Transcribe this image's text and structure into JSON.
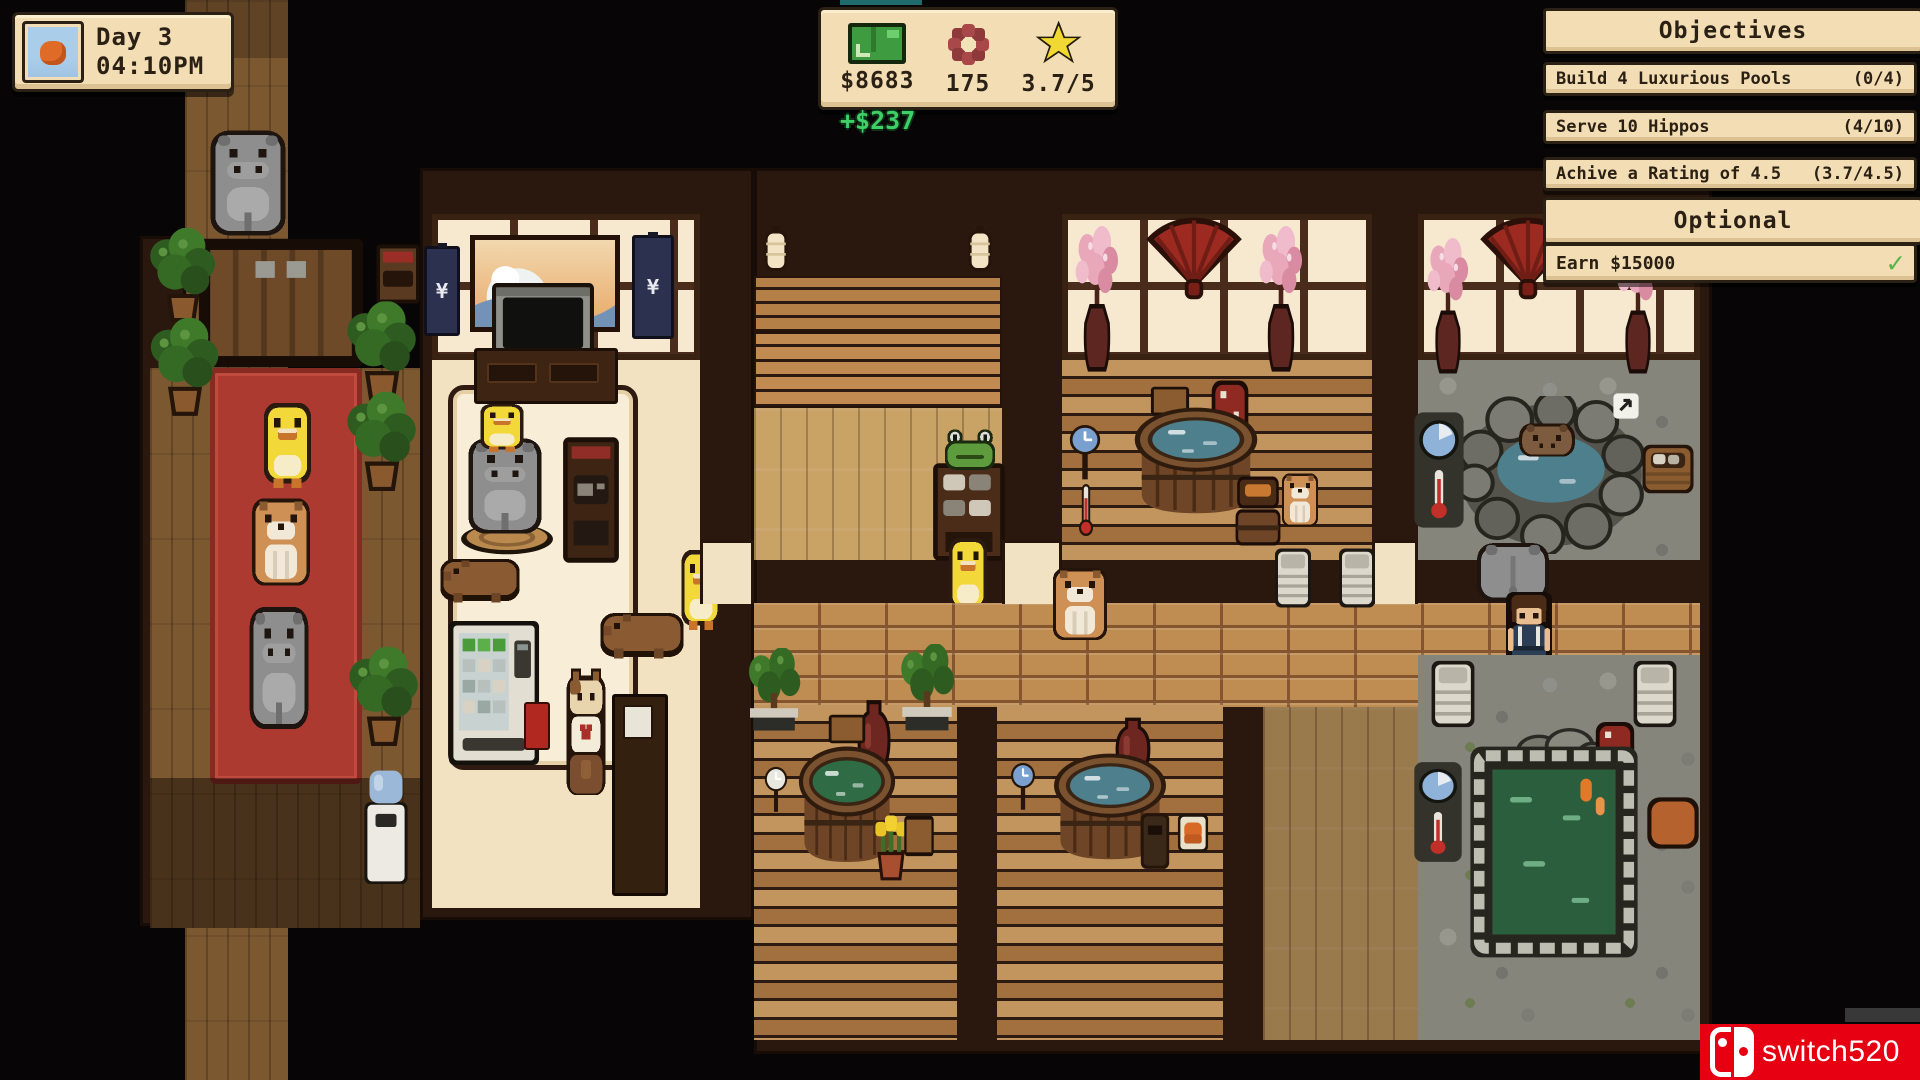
{
  "hud": {
    "day_panel": {
      "icon": "sunset-icon",
      "day_label": "Day 3",
      "time_label": "04:10PM"
    },
    "status_bar": {
      "money": {
        "icon": "money-icon",
        "value": "$8683"
      },
      "money_delta": "+$237",
      "flowers": {
        "icon": "flower-icon",
        "value": "175"
      },
      "rating": {
        "icon": "star-icon",
        "value": "3.7/5"
      }
    },
    "objectives": {
      "title": "Objectives",
      "items": [
        {
          "label": "Build 4 Luxurious Pools",
          "progress": "(0/4)"
        },
        {
          "label": "Serve 10 Hippos",
          "progress": "(4/10)"
        },
        {
          "label": "Achive a Rating of 4.5",
          "progress": "(3.7/4.5)"
        }
      ],
      "optional_title": "Optional",
      "optional_items": [
        {
          "label": "Earn $15000",
          "status": "complete",
          "status_icon": "check-icon"
        }
      ],
      "check_glyph": "✓"
    },
    "watermark": {
      "logo": "nintendo-switch-icon",
      "text": "switch520"
    }
  },
  "scene": {
    "banner_glyph": "¥"
  },
  "colors": {
    "panel_bg": "#f2ddb4",
    "panel_border": "#2b2014",
    "panel_text": "#2b2014",
    "delta_green": "#3ecf66",
    "check_green": "#55b44a",
    "watermark_red": "#e60012",
    "carpet_red": "#ad3a30",
    "water_blue": "#4d7f8c",
    "water_green": "#2f6b45",
    "pool_green_deep": "#2a5e3d"
  }
}
